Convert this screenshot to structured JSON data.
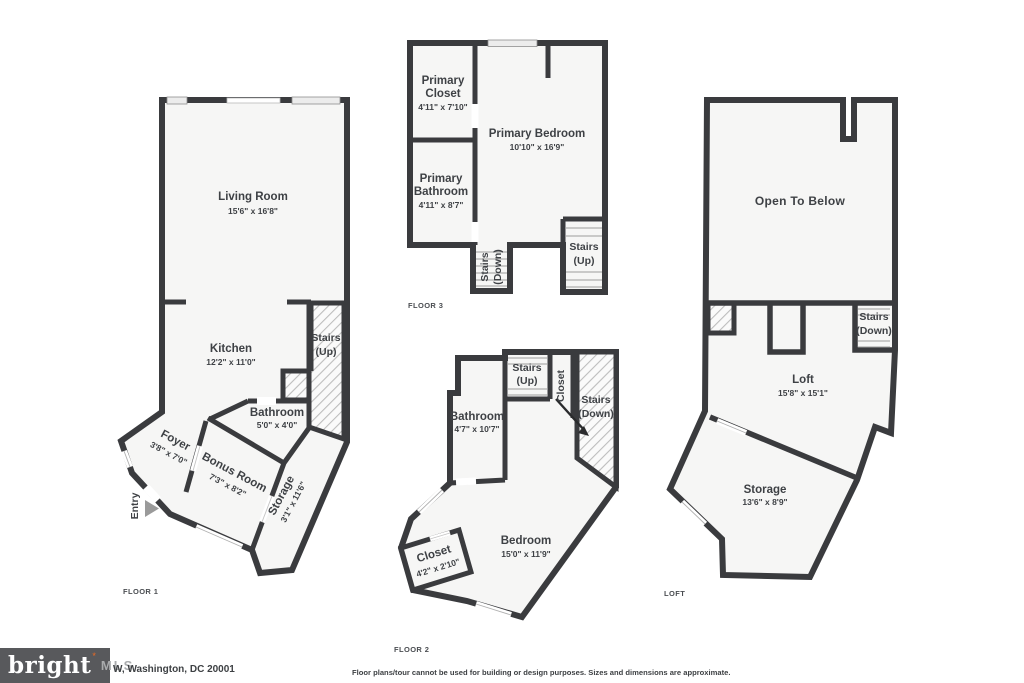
{
  "floor1": {
    "floor_label": "FLOOR 1",
    "living": {
      "name": "Living Room",
      "dims": "15'6\" x 16'8\""
    },
    "kitchen": {
      "name": "Kitchen",
      "dims": "12'2\" x 11'0\""
    },
    "stairs_up": {
      "l1": "Stairs",
      "l2": "(Up)"
    },
    "bathroom": {
      "name": "Bathroom",
      "dims": "5'0\" x 4'0\""
    },
    "foyer": {
      "name": "Foyer",
      "dims": "3'8\" x 7'0\""
    },
    "bonus": {
      "name": "Bonus Room",
      "dims": "7'3\" x 8'2\""
    },
    "storage": {
      "name": "Storage",
      "dims": "3'1\" x 11'6\""
    },
    "entry": "Entry"
  },
  "floor3": {
    "floor_label": "FLOOR 3",
    "closet": {
      "l1": "Primary",
      "l2": "Closet",
      "dims": "4'11\" x 7'10\""
    },
    "bedroom": {
      "name": "Primary Bedroom",
      "dims": "10'10\" x 16'9\""
    },
    "bathroom": {
      "l1": "Primary",
      "l2": "Bathroom",
      "dims": "4'11\" x 8'7\""
    },
    "stairs_down": {
      "l1": "Stairs",
      "l2": "(Down)"
    },
    "stairs_up": {
      "l1": "Stairs",
      "l2": "(Up)"
    }
  },
  "floor2": {
    "floor_label": "FLOOR 2",
    "stairs_up": {
      "l1": "Stairs",
      "l2": "(Up)"
    },
    "closet_upper": "Closet",
    "stairs_down": {
      "l1": "Stairs",
      "l2": "(Down)"
    },
    "bathroom": {
      "name": "Bathroom",
      "dims": "4'7\" x 10'7\""
    },
    "bedroom": {
      "name": "Bedroom",
      "dims": "15'0\" x 11'9\""
    },
    "closet": {
      "name": "Closet",
      "dims": "4'2\" x 2'10\""
    }
  },
  "loft": {
    "floor_label": "LOFT",
    "open_below": "Open To Below",
    "stairs_down": {
      "l1": "Stairs",
      "l2": "(Down)"
    },
    "loft_room": {
      "name": "Loft",
      "dims": "15'8\" x 15'1\""
    },
    "storage": {
      "name": "Storage",
      "dims": "13'6\" x 8'9\""
    }
  },
  "footer": {
    "brand": "bright",
    "brand_mark": "*",
    "brand_mls": "MLS",
    "address": "W, Washington, DC 20001",
    "disclaimer": "Floor plans/tour cannot be used for building or design purposes. Sizes and dimensions are approximate."
  },
  "colors": {
    "wall": "#3a3b3e",
    "floor_fill": "#f6f6f5",
    "text": "#3e4145",
    "logo_bg": "#58595c",
    "logo_accent": "#f06b22"
  }
}
